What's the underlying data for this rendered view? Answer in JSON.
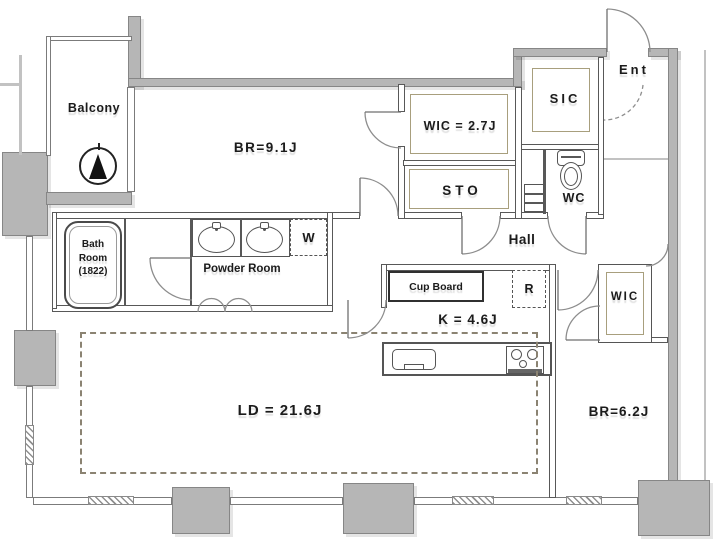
{
  "plan": {
    "rooms": {
      "balcony": "Balcony",
      "bedroom_main": "BR=9.1J",
      "wic_main": "WIC = 2.7J",
      "storage": "STO",
      "shoes_closet": "SIC",
      "entrance": "Ent",
      "toilet_room": "WC",
      "hall": "Hall",
      "bathroom": {
        "line1": "Bath",
        "line2": "Room",
        "line3": "(1822)"
      },
      "powder_room": "Powder Room",
      "washer_space": "W",
      "cupboard": "Cup Board",
      "refrigerator_space": "R",
      "kitchen": "K = 4.6J",
      "living_dining": "LD = 21.6J",
      "wic_sub": "WIC",
      "bedroom_sub": "BR=6.2J"
    },
    "icons": {
      "north_arrow": "north-arrow-compass",
      "bathtub": "bathtub",
      "vanity_sinks": "double-vanity-sink",
      "toilet": "toilet",
      "kitchen_sink": "kitchen-sink",
      "stove": "gas-stove",
      "washer": "washing-machine-space"
    },
    "colors": {
      "wall": "#b6b6b6",
      "line": "#585858",
      "closet_trim": "#a89f7d",
      "text": "#1b1b1b"
    }
  }
}
